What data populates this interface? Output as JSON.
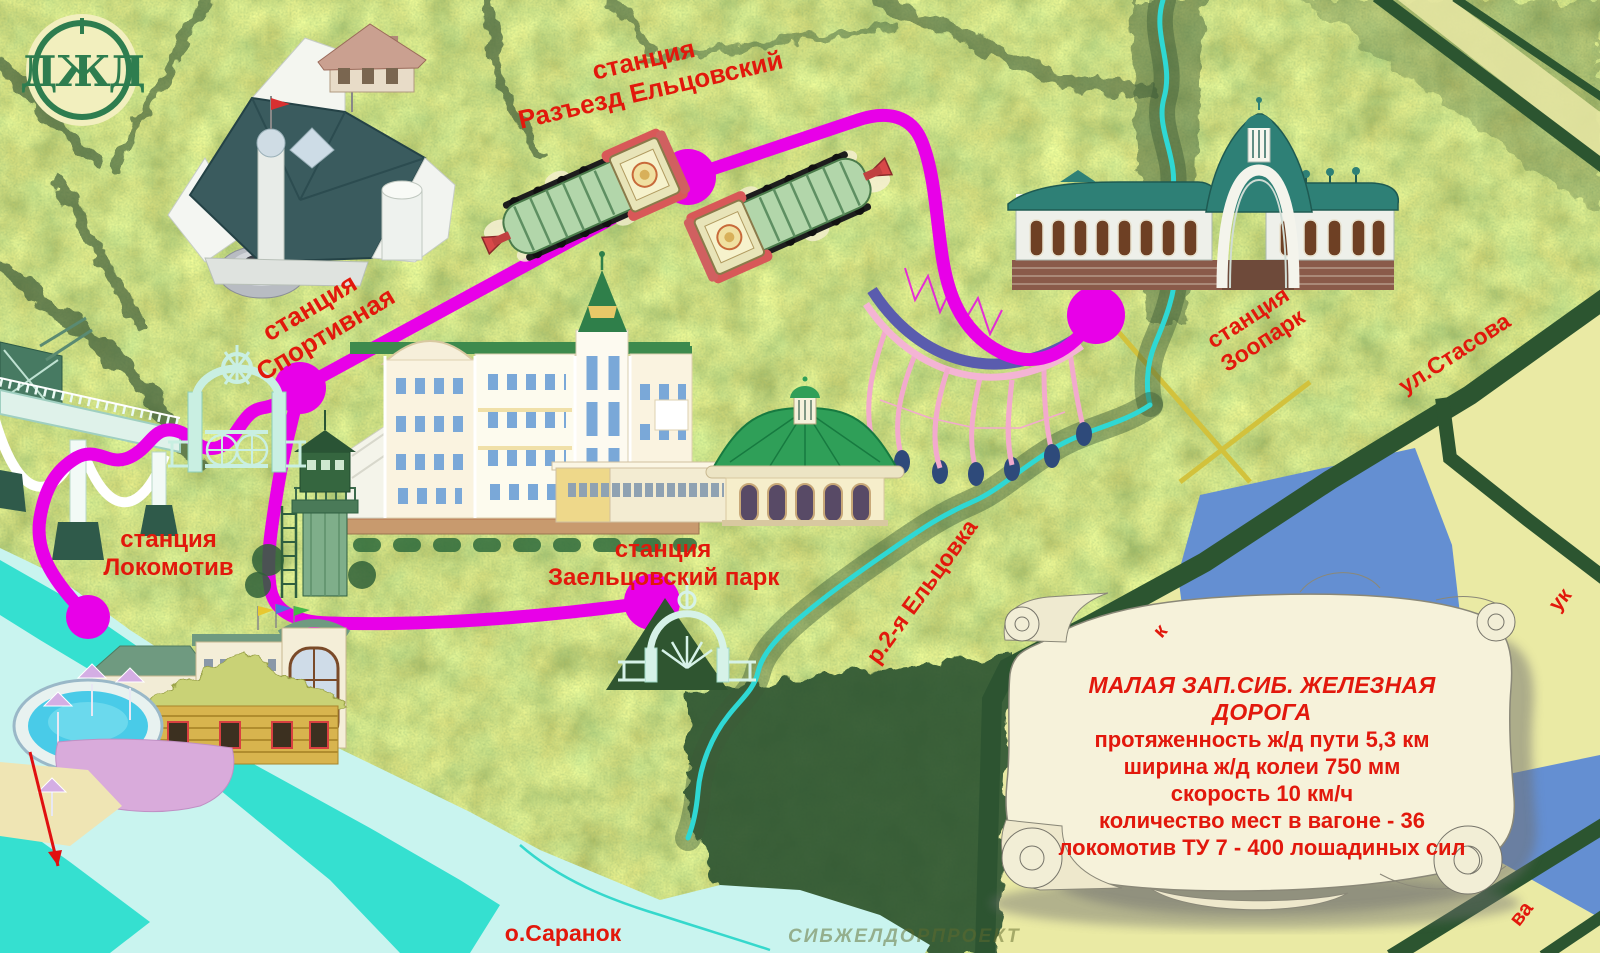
{
  "logo": {
    "monogram": "ДЖД"
  },
  "stations": {
    "razezd": {
      "line1": "станция",
      "line2": "Разъезд Ельцовский"
    },
    "sportivnaya": {
      "line1": "станция",
      "line2": "Спортивная"
    },
    "zoopark": {
      "line1": "станция",
      "line2": "Зоопарк"
    },
    "lokomotiv": {
      "line1": "станция",
      "line2": "Локомотив"
    },
    "zaeltsovsky": {
      "line1": "станция",
      "line2": "Заельцовский парк"
    }
  },
  "streets": {
    "stasova": "ул.Стасова",
    "fragment_right": "ук",
    "fragment_left": "к",
    "fragment_bottom": "ва"
  },
  "water": {
    "river2": "р.2-я Ельцовка",
    "island": "о.Саранок"
  },
  "info_scroll": {
    "title": "МАЛАЯ  ЗАП.СИБ. ЖЕЛЕЗНАЯ ДОРОГА",
    "line1": "протяженность  ж/д  пути  5,3 км",
    "line2": "ширина ж/д колеи 750 мм",
    "line3": "скорость 10 км/ч",
    "line4": "количество мест в вагоне - 36",
    "line5": "локомотив ТУ 7 - 400 лошадиных сил"
  },
  "watermark": "СИБЖЕЛДОРПРОЕКТ",
  "colors": {
    "route": "#e800e8",
    "label_red": "#e2180c",
    "stream": "#2fd8d4",
    "road_green": "#2c5530",
    "river_pale": "#c9f4ef",
    "river_teal": "#35e0d0",
    "khaki": "#eaeaa4",
    "lake_blue": "#648fd2",
    "scroll_cream": "#f6f2da"
  }
}
